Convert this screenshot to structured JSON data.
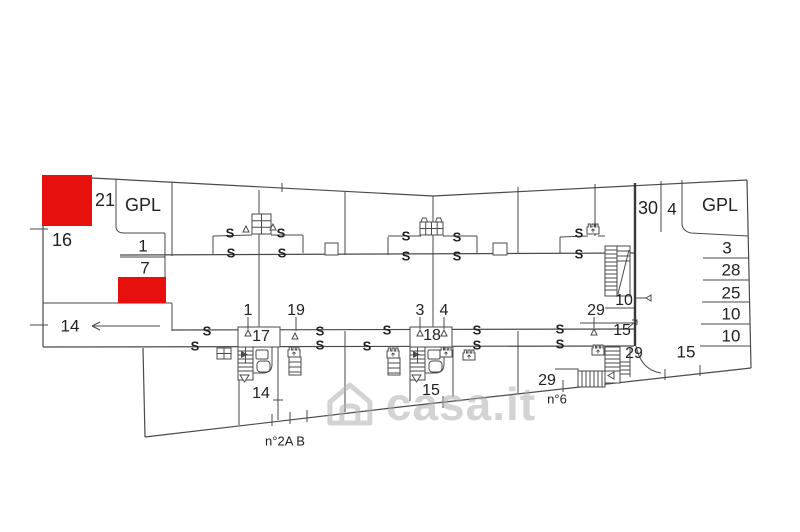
{
  "watermark": {
    "text": "casa.it"
  },
  "colors": {
    "highlight_red": "#e8100e",
    "line": "#4a4a4a",
    "text": "#222222",
    "watermark_gray": "#bdbdbd"
  },
  "labels": {
    "s_mark": "S",
    "parcel_21": "21",
    "gpl_left": "GPL",
    "parcel_16": "16",
    "parcel_1": "1",
    "parcel_7": "7",
    "parcel_14": "14",
    "parcel_30": "30",
    "parcel_4": "4",
    "gpl_right": "GPL",
    "row_3": "3",
    "row_28": "28",
    "row_25": "25",
    "row_10a": "10",
    "row_10b": "10",
    "stair_10": "10",
    "stair_29": "29",
    "stair_15": "15",
    "corner_29": "29",
    "corner_15": "15",
    "mid_29": "29",
    "entrance_n6": "n°6",
    "room_15": "15",
    "room_14": "14",
    "unit_17": "17",
    "unit_18": "18",
    "door_1": "1",
    "door_19": "19",
    "door_3": "3",
    "door_4": "4",
    "door_29": "29",
    "entrance_n2ab": "n°2A B"
  }
}
